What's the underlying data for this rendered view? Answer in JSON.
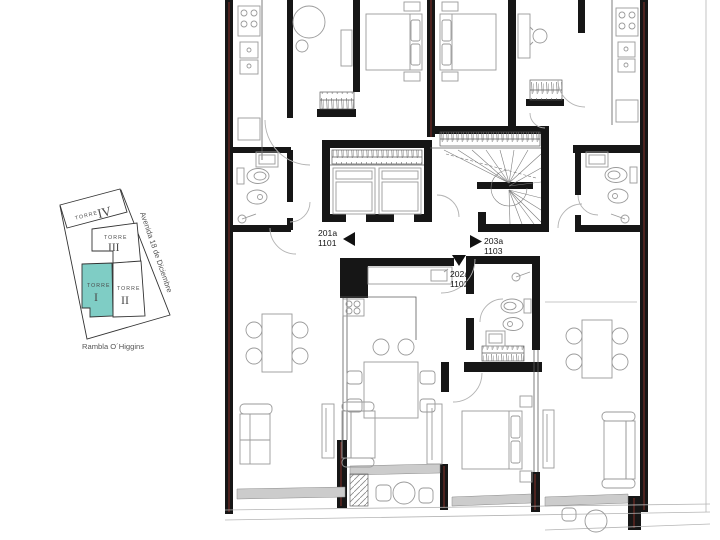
{
  "page": {
    "background": "#ffffff"
  },
  "keymap": {
    "highlight_color": "#7fcdc5",
    "towers": [
      {
        "label": "TORRE",
        "numeral": "IV",
        "highlighted": false
      },
      {
        "label": "TORRE",
        "numeral": "III",
        "highlighted": false
      },
      {
        "label": "TORRE",
        "numeral": "I",
        "highlighted": true
      },
      {
        "label": "TORRE",
        "numeral": "II",
        "highlighted": false
      }
    ],
    "streets": {
      "side": "Avenida 18 de Diciembre",
      "bottom": "Rambla O´Higgins"
    }
  },
  "plan": {
    "units": [
      {
        "code": "201a",
        "number": "1101",
        "arrow": "left"
      },
      {
        "code": "203a",
        "number": "1103",
        "arrow": "right"
      },
      {
        "code": "202a",
        "number": "1102",
        "arrow": "down"
      }
    ],
    "colors": {
      "wall": "#161616",
      "accent_red": "#7b2e27",
      "furniture": "#9a9a9a",
      "glass": "#cccccc"
    }
  }
}
